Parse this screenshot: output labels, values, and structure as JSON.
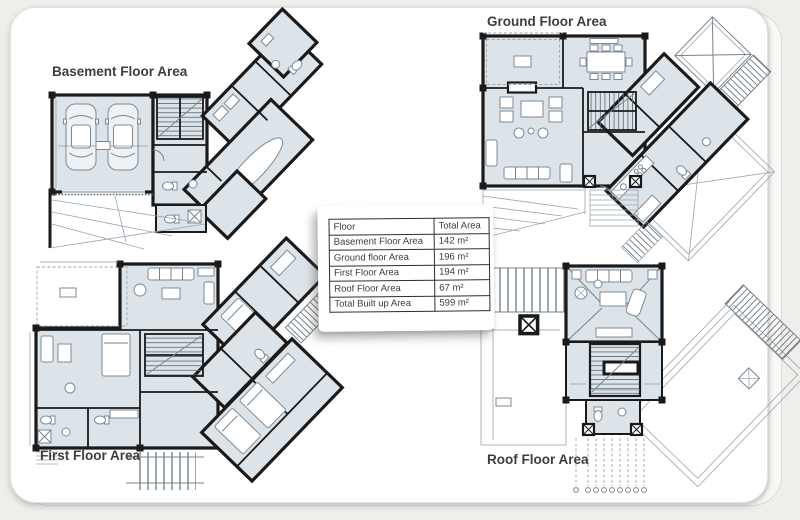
{
  "plans": {
    "basement": {
      "label": "Basement Floor Area"
    },
    "ground": {
      "label": "Ground Floor Area"
    },
    "first": {
      "label": "First Floor Area"
    },
    "roof": {
      "label": "Roof Floor Area"
    }
  },
  "area_table": {
    "header": {
      "floor": "Floor",
      "total_area": "Total Area"
    },
    "rows": [
      {
        "floor": "Basement Floor Area",
        "area": "142 m²"
      },
      {
        "floor": "Ground floor Area",
        "area": "196 m²"
      },
      {
        "floor": "First Floor Area",
        "area": "194 m²"
      },
      {
        "floor": "Roof Floor Area",
        "area": "67 m²"
      },
      {
        "floor": "Total Built up Area",
        "area": "599 m²"
      }
    ]
  },
  "colors": {
    "room_fill": "#dce4ea",
    "wall": "#1a1a1a",
    "thin_line": "#9aa6af",
    "label_text": "#3e3e3e",
    "sheet": "#ffffff",
    "page_background": "#efeeeb",
    "table_border": "#2f2f2f"
  }
}
